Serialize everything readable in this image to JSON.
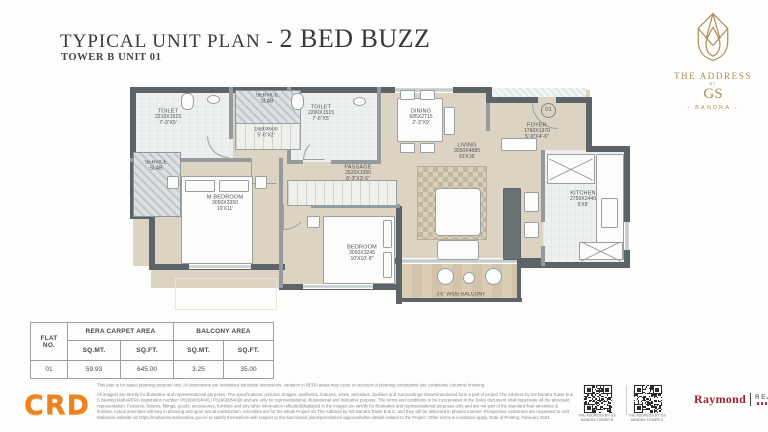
{
  "header": {
    "title_prefix": "TYPICAL UNIT PLAN - ",
    "title_emphasis": "2 BED BUZZ",
    "subtitle": "TOWER B UNIT 01"
  },
  "brand": {
    "line1": "THE ADDRESS",
    "by": "BY",
    "line2": "GS",
    "line3": "- BANDRA -"
  },
  "plan": {
    "unit_number": "01",
    "rooms": {
      "toilet1": {
        "name": "TOILET",
        "mm": "2210X1515",
        "ft": "7'-3\"X5'"
      },
      "service_top": {
        "name": "SERVICE SLAB"
      },
      "niche": {
        "mm": "1680X600",
        "ft": "5'-6\"X2'"
      },
      "toilet2": {
        "name": "TOILET",
        "mm": "2290X1515",
        "ft": "7'-6\"X5'"
      },
      "dining": {
        "name": "DINING",
        "mm": "685X2715",
        "ft": "2'-3\"X9'"
      },
      "foyer": {
        "name": "FOYER",
        "mm": "1760X1370",
        "ft": "5'-9\"X4'-6\""
      },
      "kitchen": {
        "name": "KITCHEN",
        "mm": "2750X2440",
        "ft": "9'X8'"
      },
      "service_left": {
        "name": "SERVICE SLAB"
      },
      "mbedroom": {
        "name": "M.BEDROOM",
        "mm": "3050X3350",
        "ft": "10'X11'"
      },
      "passage": {
        "name": "PASSAGE",
        "mm": "2520X1050",
        "ft": "8'-3\"X3'-5\""
      },
      "living": {
        "name": "LIVING",
        "mm": "3050X4885",
        "ft": "10'X16'"
      },
      "bedroom": {
        "name": "BEDROOM",
        "mm": "3050X3245",
        "ft": "10'X10'-8\""
      },
      "balcony": {
        "name": "3'6\" WIDE BALCONY"
      }
    }
  },
  "area_table": {
    "col_flat": "FLAT NO.",
    "group_rera": "RERA CARPET AREA",
    "group_balcony": "BALCONY AREA",
    "col_sqmt": "SQ.MT.",
    "col_sqft": "SQ.FT.",
    "row": {
      "flat": "01",
      "rera_sqmt": "59.93",
      "rera_sqft": "645.00",
      "balcony_sqmt": "3.25",
      "balcony_sqft": "35.00"
    }
  },
  "footer": {
    "logo_text": "CRD",
    "disclaimer_line1": "This plan is for space planning purpose only. All dimensions are unfinished structural dimensions, variation in RERA areas may occur on account of planning constraints/ site conditions/ columns/ finishing.",
    "disclaimer_body": "All image/s are strictly for illustrative and representational purposes. The specifications, pictures, images, aesthetics, features, views, amenities, facilities and surroundings shown/mentioned form a part of project The Address by GS Bandra Tower B & C bearing MahaRERA registration number: P51800054045 / P51800054028 and are only for representational, illustrational and indicative purpose. The terms and conditions to be incorporated in the Sales document shall supersede all the aforesaid representation. Features, fixtures, fittings, goods, accessories, furniture and any other information reflected/displayed in the images are strictly for illustrative and representational purposes only and are not part of the standard final amenities & finishes. Actual amenities will vary in planning and upon actual construction. Amenities are for the whole Project viz The Address by GS Bandra Tower B & C, and they will be delivered in phased manner. Prospective customers are requested to visit Maharera website viz https://maharera.mahaonline.gov.in/ to satisfy themselves with respect to the sanctioned plans/permission/ approval/other details related to the Project. Other terms & conditions apply. Date of Printing: February 2024.",
    "qr1_caption": "THE ADDRESS BY GS BANDRA TOWER B",
    "qr2_caption": "THE ADDRESS BY GS BANDRA TOWER C",
    "raymond": "Raymond",
    "realty": "REALTY"
  },
  "colors": {
    "gold": "#ab8d58",
    "wall": "#5c6467",
    "accent_orange": "#ef8220",
    "raymond_red": "#9c2130"
  }
}
